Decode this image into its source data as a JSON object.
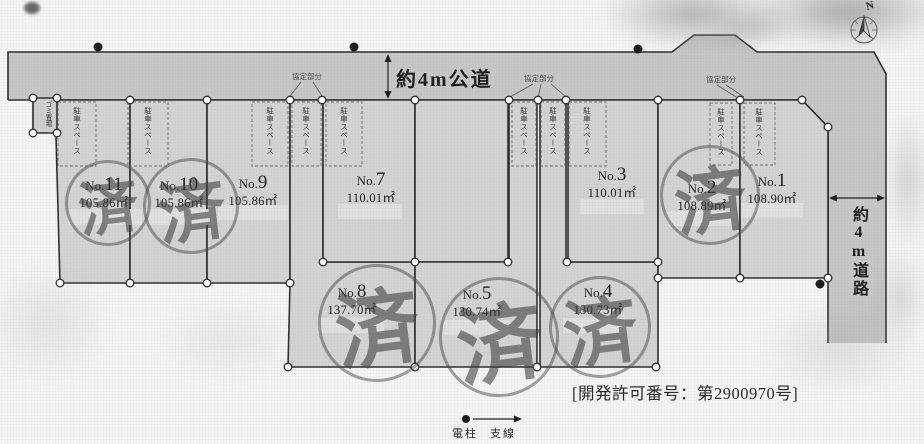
{
  "roads": {
    "top_label": "約4m公道",
    "right_label": "約4m道路"
  },
  "labels": {
    "lot_prefix": "No.",
    "parking": "駐車スペース",
    "agreement": "協定部分",
    "garbage": "ゴミ置場",
    "stamp": "済",
    "compass_n": "N",
    "legend_pole": "電柱",
    "legend_wire": "支線",
    "permit": "[開発許可番号：第2900970号]"
  },
  "lots": [
    {
      "number": "11",
      "area": "105.86㎡",
      "sold": true
    },
    {
      "number": "10",
      "area": "105.86㎡",
      "sold": true
    },
    {
      "number": "9",
      "area": "105.86㎡",
      "sold": false
    },
    {
      "number": "7",
      "area": "110.01㎡",
      "sold": false
    },
    {
      "number": "3",
      "area": "110.01㎡",
      "sold": false
    },
    {
      "number": "2",
      "area": "108.89㎡",
      "sold": true
    },
    {
      "number": "1",
      "area": "108.90㎡",
      "sold": false
    },
    {
      "number": "8",
      "area": "137.70㎡",
      "sold": true
    },
    {
      "number": "5",
      "area": "130.74㎡",
      "sold": true
    },
    {
      "number": "4",
      "area": "130.73㎡",
      "sold": true
    }
  ]
}
